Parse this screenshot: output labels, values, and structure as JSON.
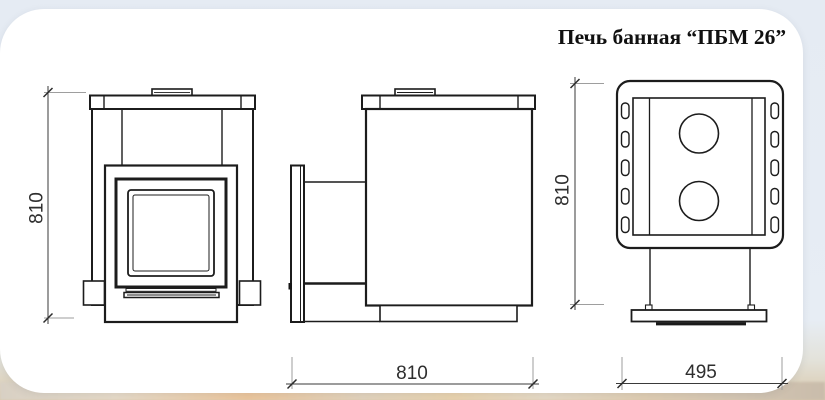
{
  "title": "Печь банная “ПБМ 26”",
  "dimensions": {
    "front_height": "810",
    "plan_depth": "810",
    "side_depth": "810",
    "plan_width": "495"
  }
}
